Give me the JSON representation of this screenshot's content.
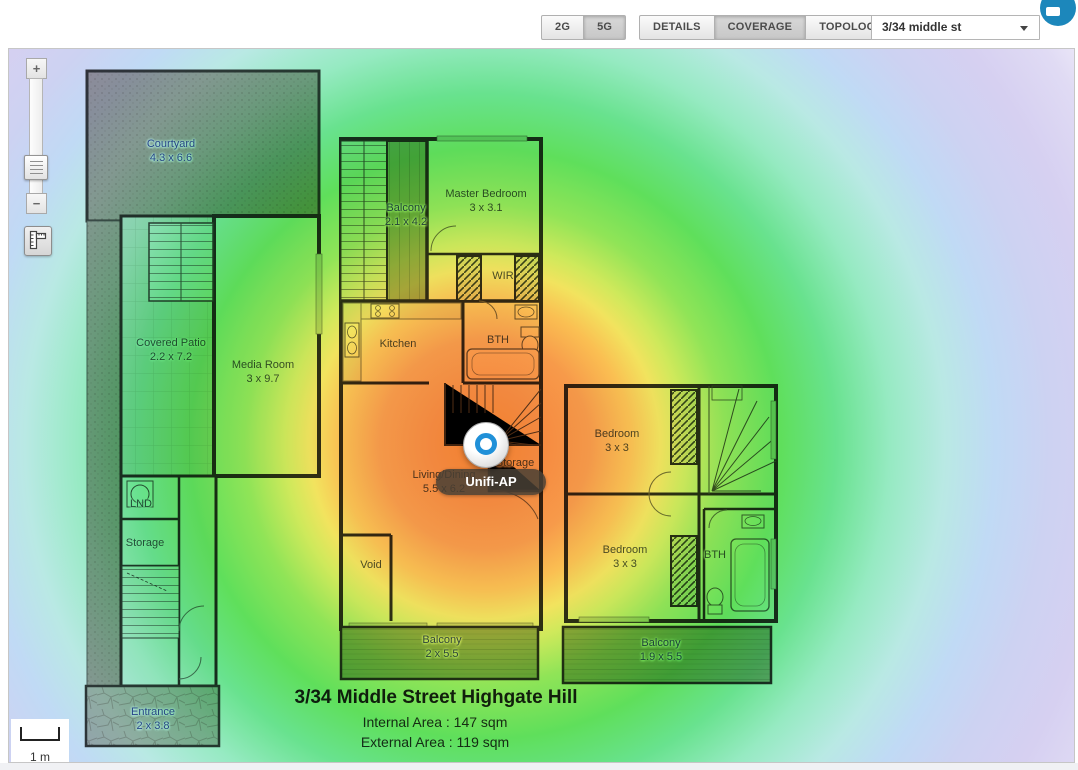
{
  "header": {
    "band_buttons": [
      {
        "label": "2G",
        "active": false
      },
      {
        "label": "5G",
        "active": true
      }
    ],
    "view_buttons": [
      {
        "label": "DETAILS",
        "active": false
      },
      {
        "label": "COVERAGE",
        "active": true
      },
      {
        "label": "TOPOLOGY",
        "active": false
      }
    ],
    "map_select": {
      "value": "3/34 middle st"
    },
    "chat_icon_color": "#1c87bb"
  },
  "map": {
    "controls": {
      "zoom_in": "+",
      "zoom_out": "−"
    },
    "scale": {
      "label": "1 m"
    },
    "ap": {
      "tooltip": "Unifi-AP",
      "ring_color": "#2090d8"
    },
    "rooms": [
      {
        "id": "courtyard",
        "name": "Courtyard",
        "dims": "4.3 x 6.6",
        "outdoor": true
      },
      {
        "id": "balcony-top",
        "name": "Balcony",
        "dims": "2.1 x 4.2",
        "outdoor": true
      },
      {
        "id": "master-bedroom",
        "name": "Master Bedroom",
        "dims": "3 x 3.1",
        "outdoor": false
      },
      {
        "id": "wir",
        "name": "WIR",
        "dims": "",
        "outdoor": false
      },
      {
        "id": "covered-patio",
        "name": "Covered Patio",
        "dims": "2.2 x 7.2",
        "outdoor": false
      },
      {
        "id": "media-room",
        "name": "Media Room",
        "dims": "3 x 9.7",
        "outdoor": false
      },
      {
        "id": "kitchen",
        "name": "Kitchen",
        "dims": "",
        "outdoor": false
      },
      {
        "id": "bth-top",
        "name": "BTH",
        "dims": "",
        "outdoor": false
      },
      {
        "id": "lnd",
        "name": "LND",
        "dims": "",
        "outdoor": false
      },
      {
        "id": "storage-left",
        "name": "Storage",
        "dims": "",
        "outdoor": false
      },
      {
        "id": "living-dining",
        "name": "Living/Dining",
        "dims": "5.5 x 6.2",
        "outdoor": false
      },
      {
        "id": "storage-mid",
        "name": "Storage",
        "dims": "",
        "outdoor": false
      },
      {
        "id": "void",
        "name": "Void",
        "dims": "",
        "outdoor": false
      },
      {
        "id": "bedroom-1",
        "name": "Bedroom",
        "dims": "3 x 3",
        "outdoor": false
      },
      {
        "id": "bedroom-2",
        "name": "Bedroom",
        "dims": "3 x 3",
        "outdoor": false
      },
      {
        "id": "bth-right",
        "name": "BTH",
        "dims": "",
        "outdoor": false
      },
      {
        "id": "balcony-mid",
        "name": "Balcony",
        "dims": "2 x 5.5",
        "outdoor": true
      },
      {
        "id": "balcony-right",
        "name": "Balcony",
        "dims": "1.9 x 5.5",
        "outdoor": true
      },
      {
        "id": "entrance",
        "name": "Entrance",
        "dims": "2 x 3.8",
        "outdoor": true
      }
    ],
    "title": {
      "line1": "3/34 Middle Street Highgate Hill",
      "line2": "Internal Area : 147 sqm",
      "line3": "External Area : 119 sqm"
    },
    "heatmap": {
      "center": "ap-marker",
      "stops": [
        "#f5822e",
        "#f79a4a",
        "#fabf52",
        "#f2e35e",
        "#90e457",
        "#5fdf5b",
        "#68e28e",
        "#96eac2",
        "#b9e9e4",
        "#c0daf5",
        "#cdd2f2",
        "#d6d0f1",
        "#e0dbf4",
        "#ffffff"
      ]
    }
  }
}
